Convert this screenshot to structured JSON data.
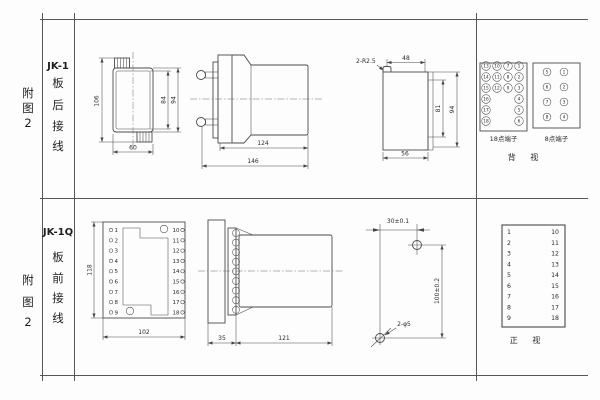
{
  "sheet": {
    "figure_label_chars": [
      "附",
      "图",
      "2"
    ],
    "row1": {
      "model": "JK-1",
      "wiring_chars": [
        "板",
        "后",
        "接",
        "线"
      ],
      "front_view": {
        "dim_total_h": "106",
        "dim_inner_h": "84",
        "dim_outer_h": "94",
        "dim_width": "60"
      },
      "side_view": {
        "dim_body": "124",
        "dim_total": "146"
      },
      "panel_view": {
        "corner_label": "2-R2.5",
        "dim_top": "48",
        "dim_inner_h": "81",
        "dim_outer_h": "94",
        "dim_bottom": "56"
      },
      "term18": {
        "label": "18点端子",
        "col_left": [
          "13",
          "14",
          "15",
          "16",
          "17",
          "18"
        ],
        "col_mid_left": [
          "10",
          "11",
          "12"
        ],
        "col_mid_right": [
          "7",
          "8",
          "9"
        ],
        "col_right": [
          "1",
          "2",
          "3",
          "4",
          "5",
          "6"
        ]
      },
      "term8": {
        "label": "8点端子",
        "col_left": [
          "5",
          "6",
          "7",
          "8"
        ],
        "col_right": [
          "1",
          "2",
          "3",
          "4"
        ]
      },
      "view_label": "背 视"
    },
    "row2": {
      "model": "JK-1Q",
      "wiring_chars": [
        "板",
        "前",
        "接",
        "线"
      ],
      "front_view": {
        "dim_h": "118",
        "dim_w": "102",
        "left_terminals": [
          "1",
          "2",
          "3",
          "4",
          "5",
          "6",
          "7",
          "8",
          "9"
        ],
        "right_terminals": [
          "10",
          "11",
          "12",
          "13",
          "14",
          "15",
          "16",
          "17",
          "18"
        ]
      },
      "side_view": {
        "dim_flange": "35",
        "dim_body": "121"
      },
      "drill_view": {
        "dim_h": "30±0.1",
        "dim_v": "100±0.2",
        "holes_label": "2-φ5"
      },
      "table_view": {
        "left": [
          "1",
          "2",
          "3",
          "4",
          "5",
          "6",
          "7",
          "8",
          "9"
        ],
        "right": [
          "10",
          "11",
          "12",
          "13",
          "14",
          "15",
          "16",
          "17",
          "18"
        ],
        "view_label": "正 视"
      }
    }
  }
}
